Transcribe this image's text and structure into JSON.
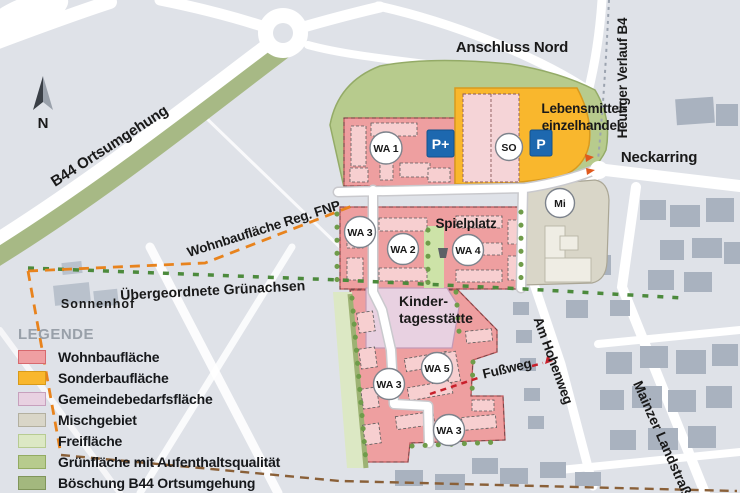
{
  "map": {
    "labels": {
      "b44": "B44 Ortsumgehung",
      "anschluss_nord": "Anschluss Nord",
      "heutiger_verlauf": "Heutiger Verlauf B4",
      "neckarring": "Neckarring",
      "lebensmittel_line1": "Lebensmittel-",
      "lebensmittel_line2": "einzelhandel",
      "wohnbau_fnp": "Wohnbaufläche Reg. FNP",
      "gruenachsen": "Übergeordnete Grünachsen",
      "sonnenhof": "Sonnenhof",
      "spielplatz": "Spielplatz",
      "kita_line1": "Kinder-",
      "kita_line2": "tagesstätte",
      "fussweg": "Fußweg",
      "am_hohenweg": "Am Hohenweg",
      "mainzer_landstrasse": "Mainzer Landstraß",
      "north": "N"
    },
    "zones": {
      "wa1": "WA 1",
      "wa2": "WA 2",
      "wa3": "WA 3",
      "wa4": "WA 4",
      "wa5": "WA 5",
      "so": "SO",
      "mi": "Mi"
    },
    "signs": {
      "p_plus": "P+",
      "p": "P"
    }
  },
  "legend": {
    "title": "LEGENDE",
    "items": [
      {
        "label": "Wohnbaufläche",
        "color": "#ef9fa2",
        "border": "#d7696e"
      },
      {
        "label": "Sonderbaufläche",
        "color": "#f9b72d",
        "border": "#d89a18"
      },
      {
        "label": "Gemeindebedarfsfläche",
        "color": "#e8d1e1",
        "border": "#c7a0bd"
      },
      {
        "label": "Mischgebiet",
        "color": "#d9d6c8",
        "border": "#b3b0a0"
      },
      {
        "label": "Freifläche",
        "color": "#dce8c4",
        "border": "#b7cb92"
      },
      {
        "label": "Grünfläche mit Aufenthaltsqualität",
        "color": "#b7cb8d",
        "border": "#93ab62"
      },
      {
        "label": "Böschung B44 Ortsumgehung",
        "color": "#a3b87e",
        "border": "#80955a"
      }
    ]
  },
  "colors": {
    "background": "#dfe2e8",
    "roads": "#ffffff",
    "existing_buildings": "#a9b2bf",
    "parking_sign_blue": "#1d68af",
    "fnp_line_orange": "#e8831d",
    "gruenachse_green": "#4c8a3c",
    "fussweg_red": "#c8202b",
    "muted_label_gray": "#9ba3af"
  }
}
